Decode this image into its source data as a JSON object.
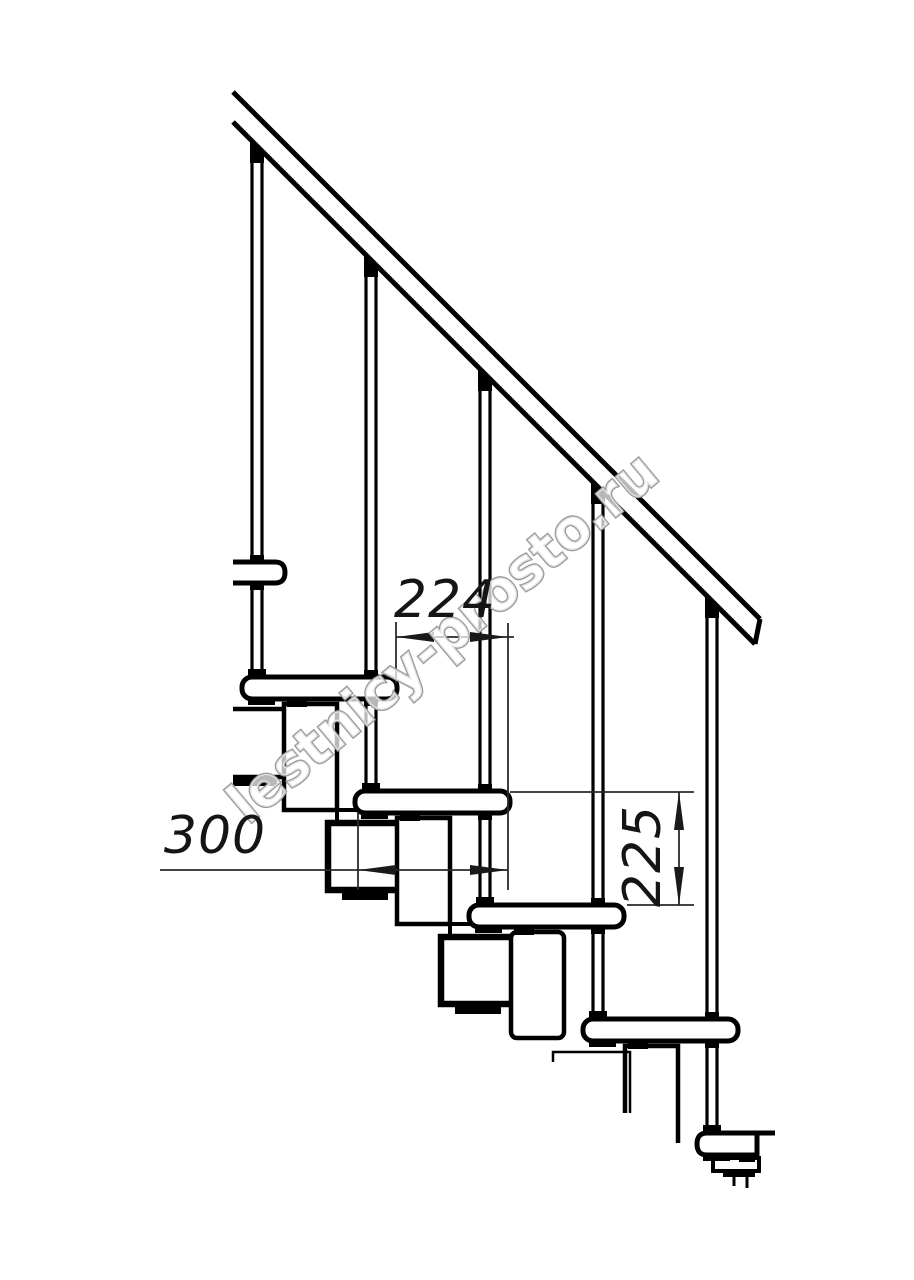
{
  "drawing": {
    "type": "staircase-side-view-technical-drawing",
    "watermark": {
      "text": "lestnicy-prosto.ru",
      "outline_color": "#9a9a9a",
      "fill_color": "#ffffff"
    },
    "dimensions": {
      "step_offset_horizontal": "224",
      "tread_depth": "300",
      "riser_height": "225"
    },
    "colors": {
      "line": "#000000",
      "dimension_line": "#2a2a2a",
      "dimension_text": "#151515",
      "background": "#ffffff"
    },
    "elements": {
      "handrail": "diagonal handrail band",
      "balusters": "5 vertical baluster posts",
      "steps": "5 staggered treads plus partial upper tread",
      "supports": "modular support chain under treads"
    }
  }
}
